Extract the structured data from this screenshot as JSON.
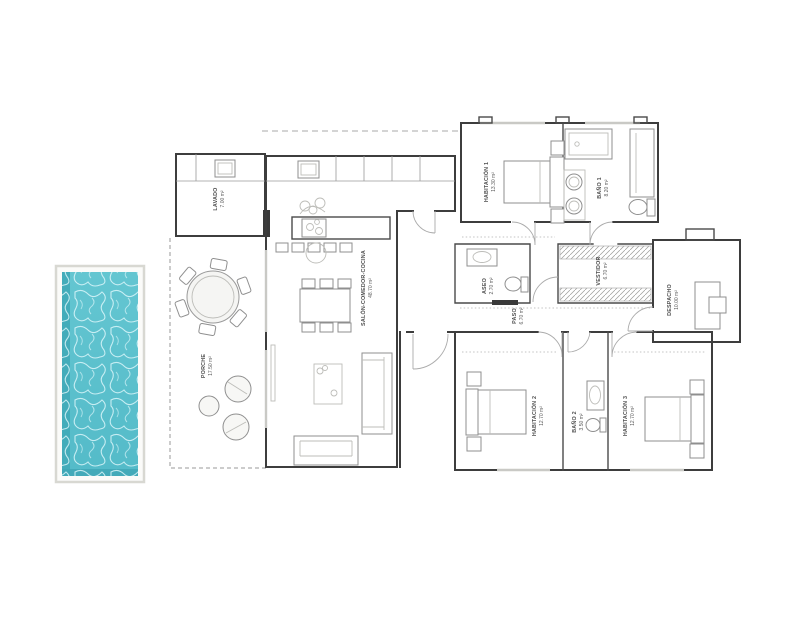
{
  "plan": {
    "rooms": [
      {
        "name": "LAVADO",
        "area": "7.00 m²"
      },
      {
        "name": "SALÓN-COMEDOR-COCINA",
        "area": "48.70 m²"
      },
      {
        "name": "PORCHE",
        "area": "17.50 m²"
      },
      {
        "name": "HABITACIÓN 1",
        "area": "13.30 m²"
      },
      {
        "name": "BAÑO 1",
        "area": "8.20 m²"
      },
      {
        "name": "VESTIDOR",
        "area": "6.70 m²"
      },
      {
        "name": "DESPACHO",
        "area": "10.00 m²"
      },
      {
        "name": "ASEO",
        "area": "2.70 m²"
      },
      {
        "name": "PASO",
        "area": "6.70 m²"
      },
      {
        "name": "HABITACIÓN 2",
        "area": "12.70 m²"
      },
      {
        "name": "BAÑO 2",
        "area": "3.50 m²"
      },
      {
        "name": "HABITACIÓN 3",
        "area": "12.70 m²"
      }
    ],
    "colors": {
      "pool_water": "#5cc3cf",
      "pool_water_edge": "#43acba",
      "pool_deck_border": "#d8d8d2",
      "wall": "#3d3d3d",
      "label_text": "#4e4e4e",
      "background": "#ffffff"
    }
  }
}
